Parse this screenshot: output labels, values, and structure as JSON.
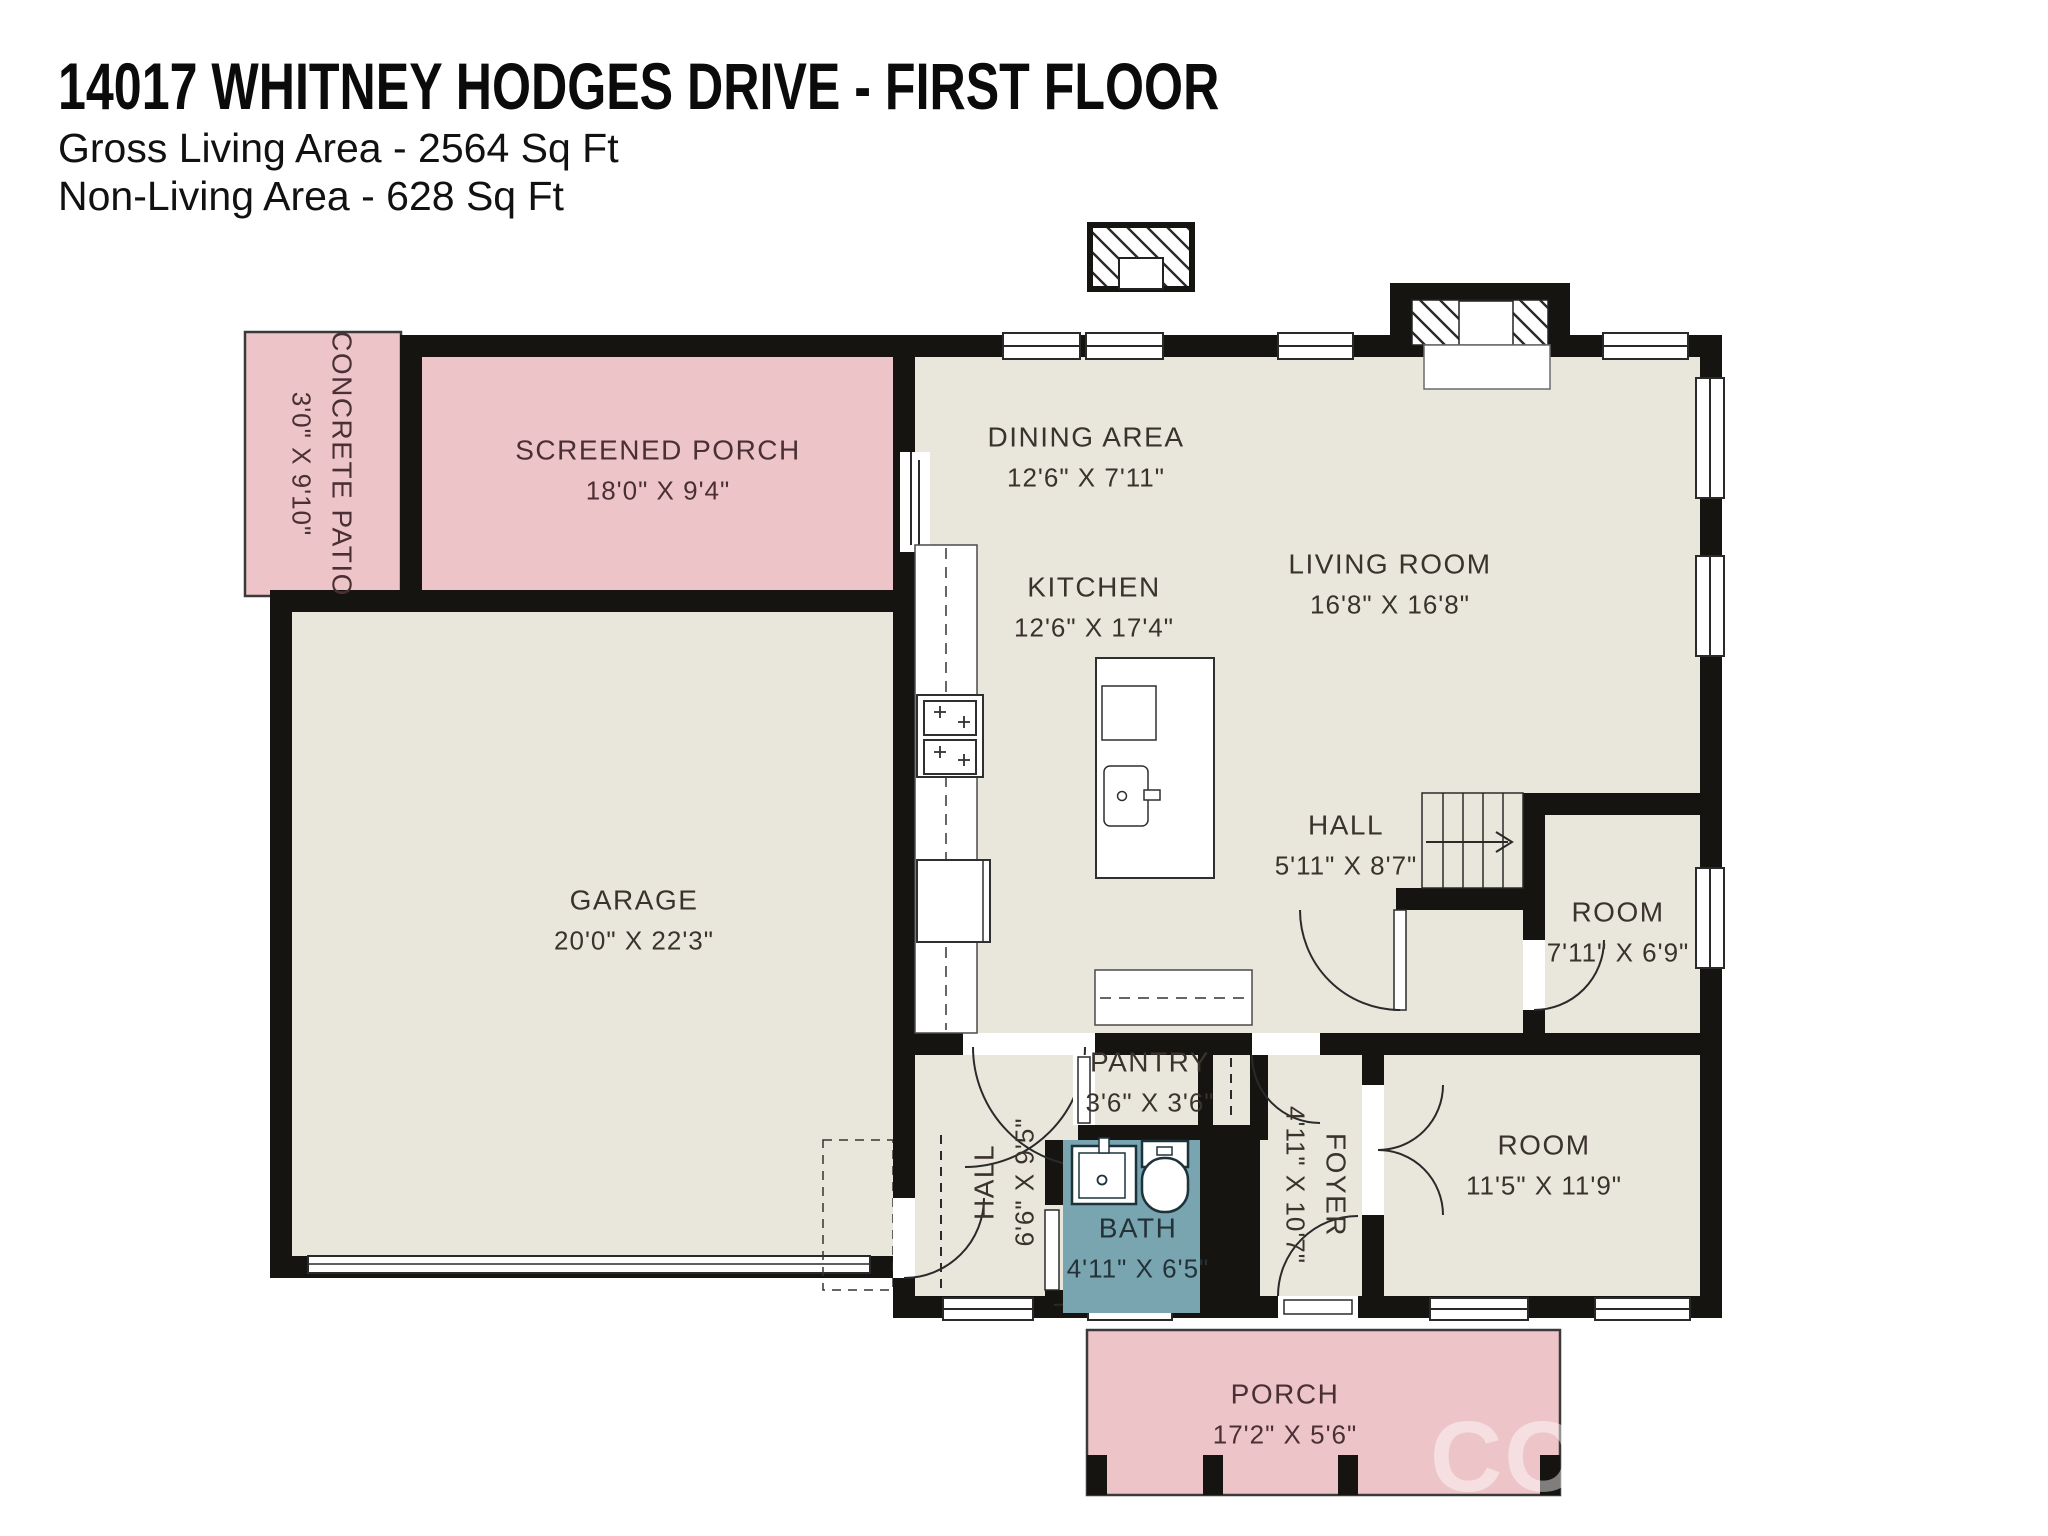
{
  "header": {
    "title": "14017 WHITNEY HODGES DRIVE - FIRST FLOOR",
    "gross_living": "Gross Living Area - 2564 Sq Ft",
    "non_living": "Non-Living Area - 628 Sq Ft"
  },
  "rooms": {
    "concrete_patio": {
      "label": "CONCRETE PATIO",
      "dims": "3'0\" X 9'10\""
    },
    "screened_porch": {
      "label": "SCREENED PORCH",
      "dims": "18'0\" X 9'4\""
    },
    "dining_area": {
      "label": "DINING AREA",
      "dims": "12'6\" X 7'11\""
    },
    "kitchen": {
      "label": "KITCHEN",
      "dims": "12'6\" X 17'4\""
    },
    "living_room": {
      "label": "LIVING ROOM",
      "dims": "16'8\" X 16'8\""
    },
    "garage": {
      "label": "GARAGE",
      "dims": "20'0\" X 22'3\""
    },
    "hall_upper": {
      "label": "HALL",
      "dims": "5'11\" X 8'7\""
    },
    "room_small": {
      "label": "ROOM",
      "dims": "7'11\" X 6'9\""
    },
    "pantry": {
      "label": "PANTRY",
      "dims": "3'6\" X 3'6\""
    },
    "hall_lower": {
      "label": "HALL",
      "dims": "6'6\" X 9'5\""
    },
    "bath": {
      "label": "BATH",
      "dims": "4'11\" X 6'5\""
    },
    "foyer": {
      "label": "FOYER",
      "dims": "4'11\" X 10'7\""
    },
    "room_bottom": {
      "label": "ROOM",
      "dims": "11'5\" X 11'9\""
    },
    "porch": {
      "label": "PORCH",
      "dims": "17'2\" X 5'6\""
    }
  },
  "colors": {
    "outdoor_pink": "#edc5c8",
    "interior_beige": "#e9e7dc",
    "bath_teal": "#79a5b1",
    "wall_black": "#161411"
  },
  "watermark": "CO"
}
